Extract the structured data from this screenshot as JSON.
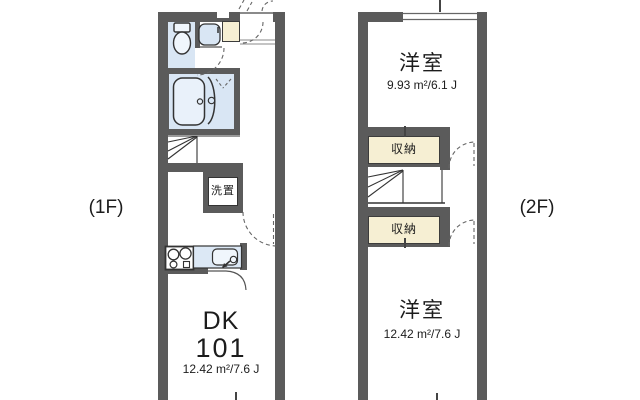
{
  "floor1": {
    "label": "(1F)",
    "unit": {
      "type": "DK",
      "number": "101",
      "area": "12.42 m²/7.6 J"
    },
    "laundry_label": "洗置"
  },
  "floor2": {
    "label": "(2F)",
    "rooms": [
      {
        "name": "洋室",
        "area": "9.93 m²/6.1 J"
      },
      {
        "name": "洋室",
        "area": "12.42 m²/7.6 J"
      }
    ],
    "closets": [
      {
        "label": "収納"
      },
      {
        "label": "収納"
      }
    ]
  },
  "colors": {
    "wall": "#5b5b5b",
    "wet_area": "#d9e6f4",
    "closet": "#f6efd3",
    "line": "#333333",
    "background": "#ffffff"
  }
}
